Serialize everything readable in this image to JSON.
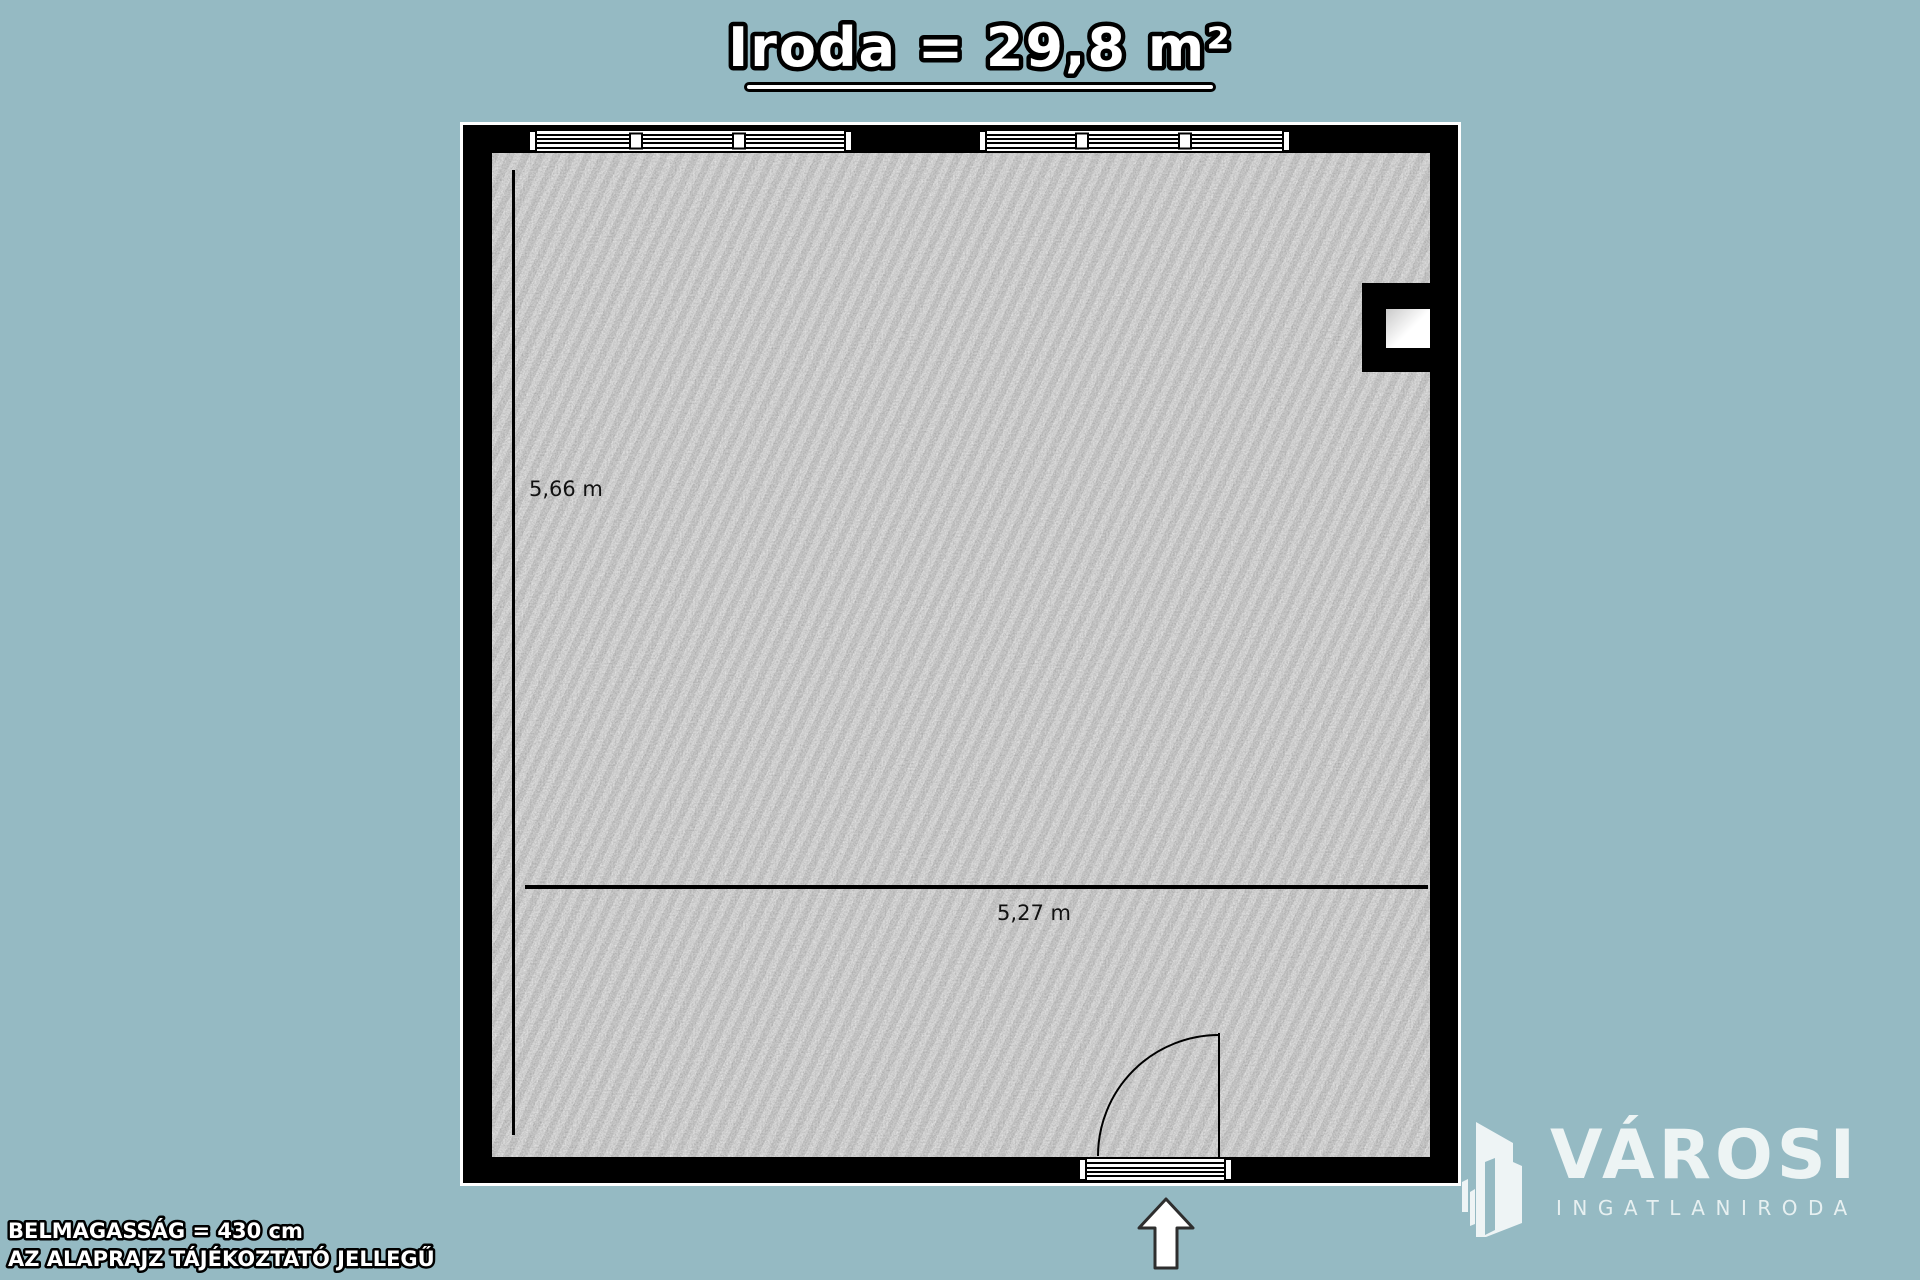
{
  "title": {
    "text": "Iroda = 29,8 m²"
  },
  "room": {
    "name": "Iroda",
    "area": "29,8 m²"
  },
  "dimensions": {
    "height_label": "5,66 m",
    "width_label": "5,27 m"
  },
  "notes": {
    "ceiling_height": "BELMAGASSÁG = 430 cm",
    "disclaimer": "AZ ALAPRAJZ TÁJÉKOZTATÓ JELLEGŰ"
  },
  "logo": {
    "brand": "VÁROSI",
    "tagline": "INGATLANIRODA"
  },
  "icons": {
    "entrance": "up-arrow-icon",
    "logo_mark": "buildings-icon"
  },
  "colors": {
    "background": "#95bac3",
    "wall": "#000000",
    "wall_outline": "#ffffff",
    "floor_base": "#9b9b9b",
    "title_fill": "#ffffff",
    "title_outline": "#000000",
    "dimension_text": "#111111",
    "logo_text": "#edf4f4"
  }
}
